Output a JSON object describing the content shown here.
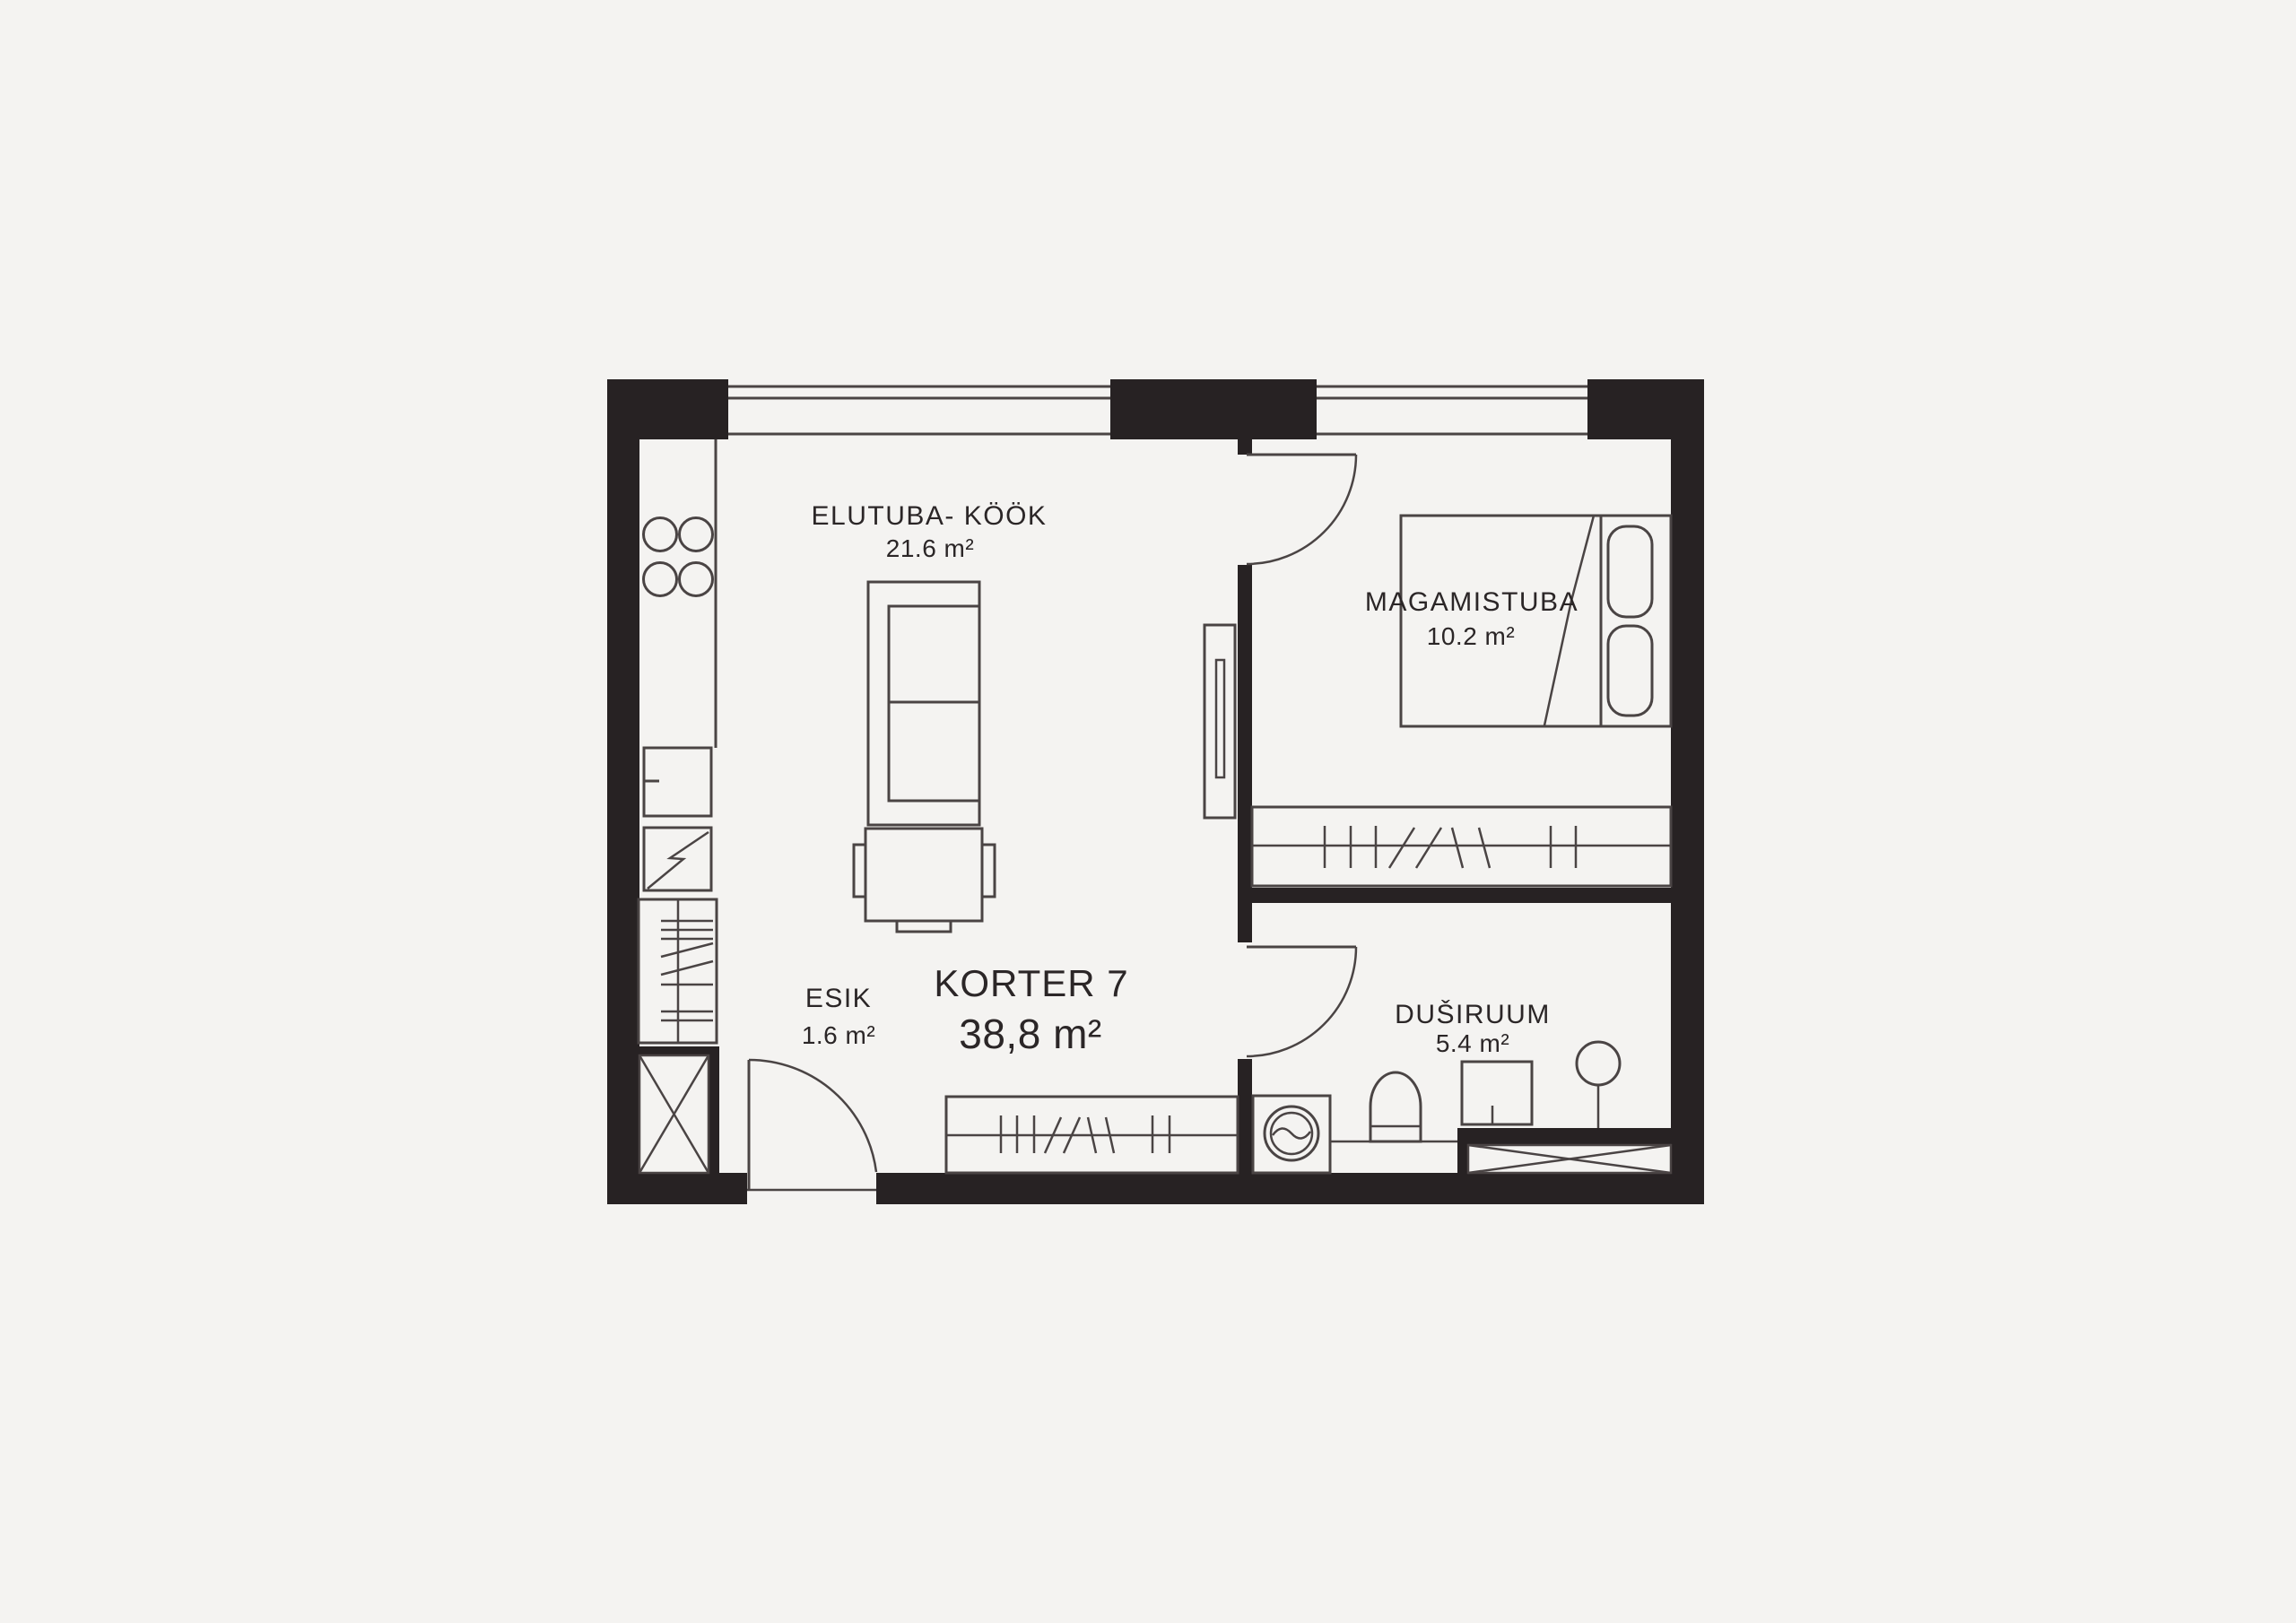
{
  "title": "KORTER 7 floor plan",
  "colors": {
    "background": "#f4f3f1",
    "walls": "#272223",
    "lines": "#4a4444",
    "text": "#2b2627"
  },
  "apartment": {
    "name": "KORTER 7",
    "total_area": "38,8 m²"
  },
  "rooms": [
    {
      "name": "ELUTUBA- KÖÖK",
      "area": "21.6 m²"
    },
    {
      "name": "MAGAMISTUBA",
      "area": "10.2 m²"
    },
    {
      "name": "ESIK",
      "area": "1.6 m²"
    },
    {
      "name": "DUŠIRUUM",
      "area": "5.4 m²"
    }
  ]
}
